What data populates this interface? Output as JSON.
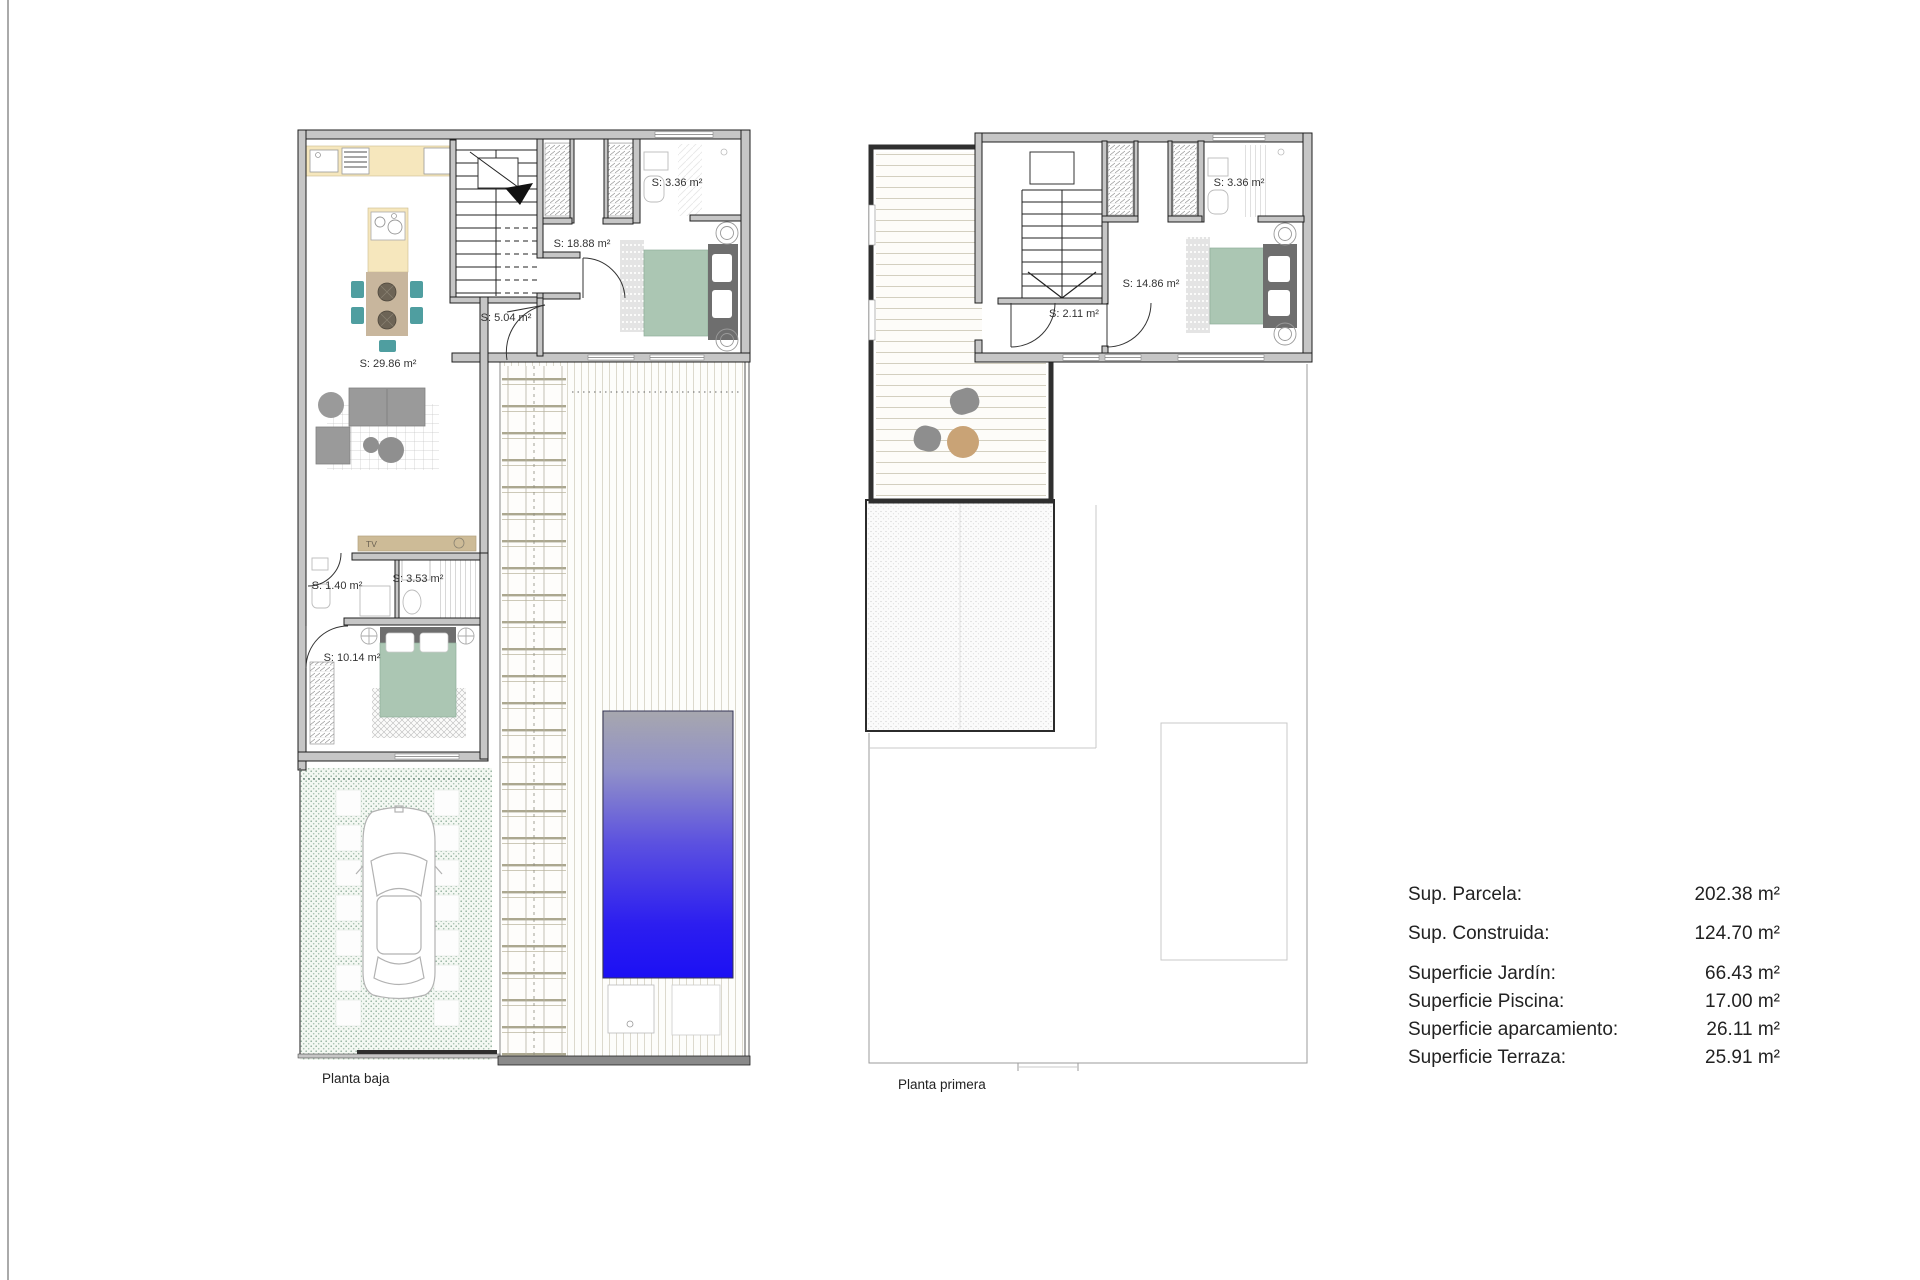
{
  "plan1": {
    "caption": "Planta baja",
    "labels": {
      "kitchen_living": "S: 29.86 m²",
      "hallway": "S: 5.04 m²",
      "bedroom_main": "S: 18.88 m²",
      "bathroom_top": "S: 3.36 m²",
      "wc": "S: 1.40 m²",
      "bathroom_small": "S: 3.53 m²",
      "bedroom_second": "S: 10.14 m²",
      "tv_unit": "TV"
    }
  },
  "plan2": {
    "caption": "Planta primera",
    "labels": {
      "hallway": "S: 2.11 m²",
      "bedroom": "S: 14.86 m²",
      "bathroom": "S: 3.36 m²"
    }
  },
  "summary": {
    "rows": [
      {
        "label": "Sup. Parcela:",
        "value": "202.38 m²"
      },
      {
        "label": "Sup. Construida:",
        "value": "124.70 m²"
      },
      {
        "label": "Superficie Jardín:",
        "value": "66.43 m²"
      },
      {
        "label": "Superficie Piscina:",
        "value": "17.00 m²"
      },
      {
        "label": "Superficie aparcamiento:",
        "value": "26.11 m²"
      },
      {
        "label": "Superficie Terraza:",
        "value": "25.91 m²"
      }
    ]
  },
  "colors": {
    "wall-fill": "#c6c6c6",
    "wall-line": "#1f1f1f",
    "bed-green": "#abc6b3",
    "headboard-gray": "#6e6e6e",
    "kitchen-cream": "#f6e7bd",
    "table-tan": "#c8b69d",
    "chair-teal": "#4f9ea0",
    "sofa-gray": "#9a9a9a",
    "tv-tan": "#cdbb97",
    "terrace-table-tan": "#c9a376",
    "pool-top": "#a7a7ae",
    "pool-mid": "#5b50e0",
    "pool-deep": "#1c10f4",
    "text": "#222222"
  }
}
